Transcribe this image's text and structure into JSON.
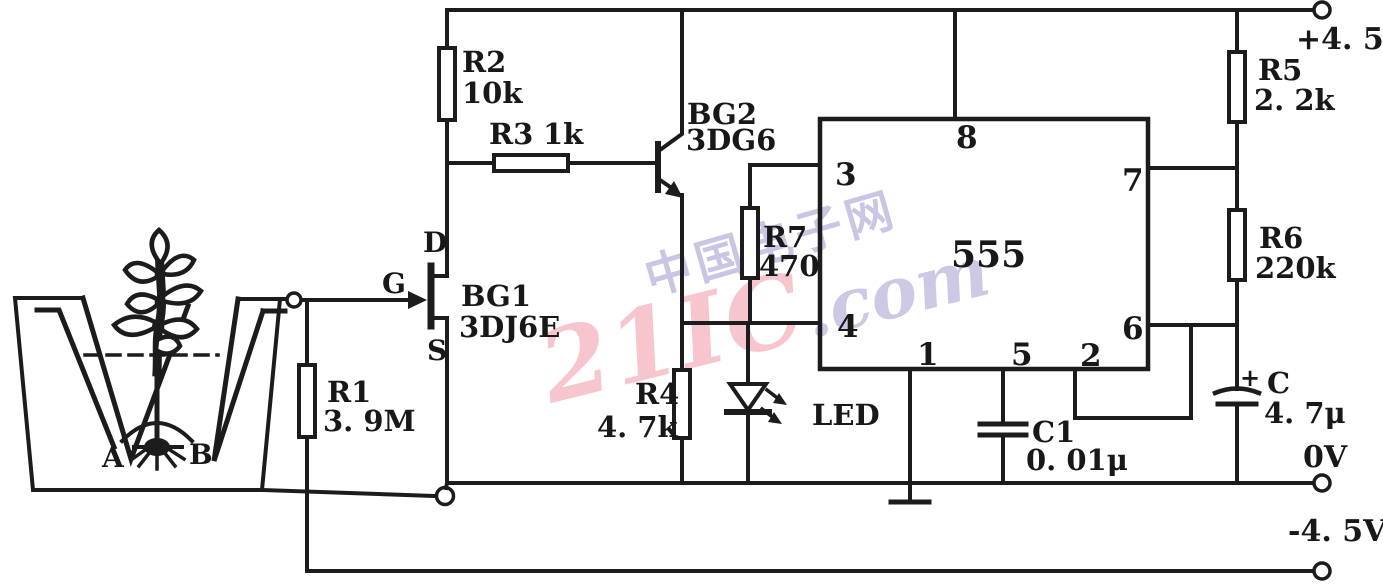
{
  "components": {
    "R1": {
      "ref": "R1",
      "value": "3. 9M"
    },
    "R2": {
      "ref": "R2",
      "value": "10k"
    },
    "R3": {
      "ref": "R3",
      "value": "1k"
    },
    "R4": {
      "ref": "R4",
      "value": "4. 7k"
    },
    "R5": {
      "ref": "R5",
      "value": "2. 2k"
    },
    "R6": {
      "ref": "R6",
      "value": "220k"
    },
    "R7": {
      "ref": "R7",
      "value": "470"
    },
    "BG1": {
      "ref": "BG1",
      "model": "3DJ6E",
      "pin_g": "G",
      "pin_d": "D",
      "pin_s": "S"
    },
    "BG2": {
      "ref": "BG2",
      "model": "3DG6"
    },
    "LED": {
      "ref": "LED"
    },
    "C1": {
      "ref": "C1",
      "value": "0. 01μ"
    },
    "C": {
      "ref": "C",
      "value": "4. 7μ",
      "polarity": "+"
    },
    "IC555": {
      "label": "555",
      "pin1": "1",
      "pin2": "2",
      "pin3": "3",
      "pin4": "4",
      "pin5": "5",
      "pin6": "6",
      "pin7": "7",
      "pin8": "8"
    }
  },
  "probes": {
    "a": "A",
    "b": "B"
  },
  "power": {
    "pos": "+4. 5V",
    "gnd": "0V",
    "neg": "-4. 5V"
  },
  "watermark": {
    "brand": "21IC",
    "suffix": ".com",
    "cn": "中国电子网",
    "brand_color": "#ec6e82",
    "cn_color": "#968bc7"
  },
  "colors": {
    "line": "#1c1c1c",
    "background": "#ffffff"
  }
}
